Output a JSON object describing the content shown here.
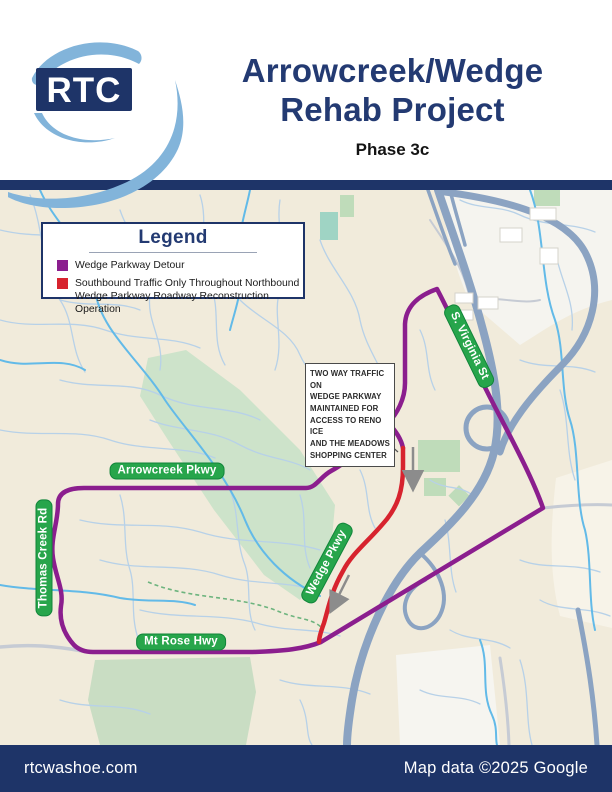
{
  "header": {
    "logo_text": "RTC",
    "title_line1": "Arrowcreek/Wedge",
    "title_line2": "Rehab Project",
    "subtitle": "Phase 3c"
  },
  "legend": {
    "title": "Legend",
    "items": [
      {
        "color": "#8b1e8e",
        "lines": [
          "Wedge Parkway Detour"
        ]
      },
      {
        "color": "#d7232e",
        "lines": [
          "Southbound Traffic Only Throughout Northbound",
          "Wedge Parkway Roadway Reconstruction Operation"
        ]
      }
    ]
  },
  "map": {
    "road_labels": [
      {
        "id": "arrowcreek",
        "text": "Arrowcreek Pkwy"
      },
      {
        "id": "thomas-creek",
        "text": "Thomas Creek Rd"
      },
      {
        "id": "mt-rose",
        "text": "Mt Rose Hwy"
      },
      {
        "id": "wedge",
        "text": "Wedge Pkwy"
      },
      {
        "id": "s-virginia",
        "text": "S. Virginia St"
      }
    ],
    "callout": {
      "lines": [
        "TWO WAY TRAFFIC ON",
        "WEDGE PARKWAY",
        "MAINTAINED FOR",
        "ACCESS TO RENO ICE",
        "AND THE MEADOWS",
        "SHOPPING CENTER"
      ]
    },
    "colors": {
      "detour_purple": "#8b1e8e",
      "southbound_red": "#d7232e",
      "label_green": "#27a54b",
      "navy": "#1e3468",
      "freeway": "#8ba3c2",
      "creek": "#62bae8"
    }
  },
  "footer": {
    "left": "rtcwashoe.com",
    "right": "Map data ©2025 Google"
  }
}
